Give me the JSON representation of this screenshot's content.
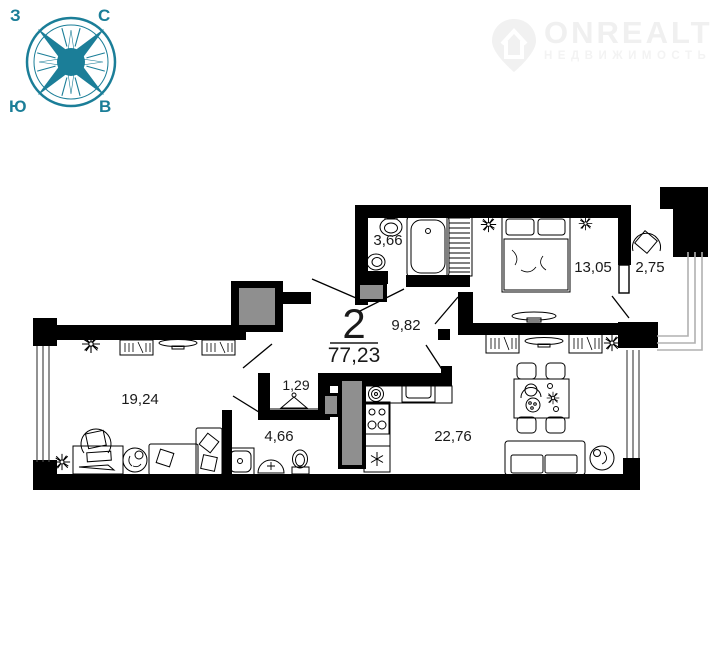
{
  "compass": {
    "west": "З",
    "north": "С",
    "south": "Ю",
    "east": "В",
    "color": "#1b7e98"
  },
  "watermark": {
    "brand": "ONREALT",
    "subtitle": "НЕДВИЖИМОСТЬ",
    "color": "#f0f0f0"
  },
  "plan": {
    "summary": {
      "rooms_count": "2",
      "total_area": "77,23"
    },
    "rooms": [
      {
        "name": "bathroom",
        "area": "3,66"
      },
      {
        "name": "bedroom",
        "area": "13,05"
      },
      {
        "name": "balcony",
        "area": "2,75"
      },
      {
        "name": "hallway",
        "area": "9,82"
      },
      {
        "name": "living-room",
        "area": "19,24"
      },
      {
        "name": "closet",
        "area": "1,29"
      },
      {
        "name": "shower-room",
        "area": "4,66"
      },
      {
        "name": "kitchen-living-room",
        "area": "22,76"
      }
    ],
    "colors": {
      "wall": "#000000",
      "door_leaf": "#8f8f8f",
      "glazing": "#b0b0b0",
      "label": "#1a1a1a"
    }
  }
}
